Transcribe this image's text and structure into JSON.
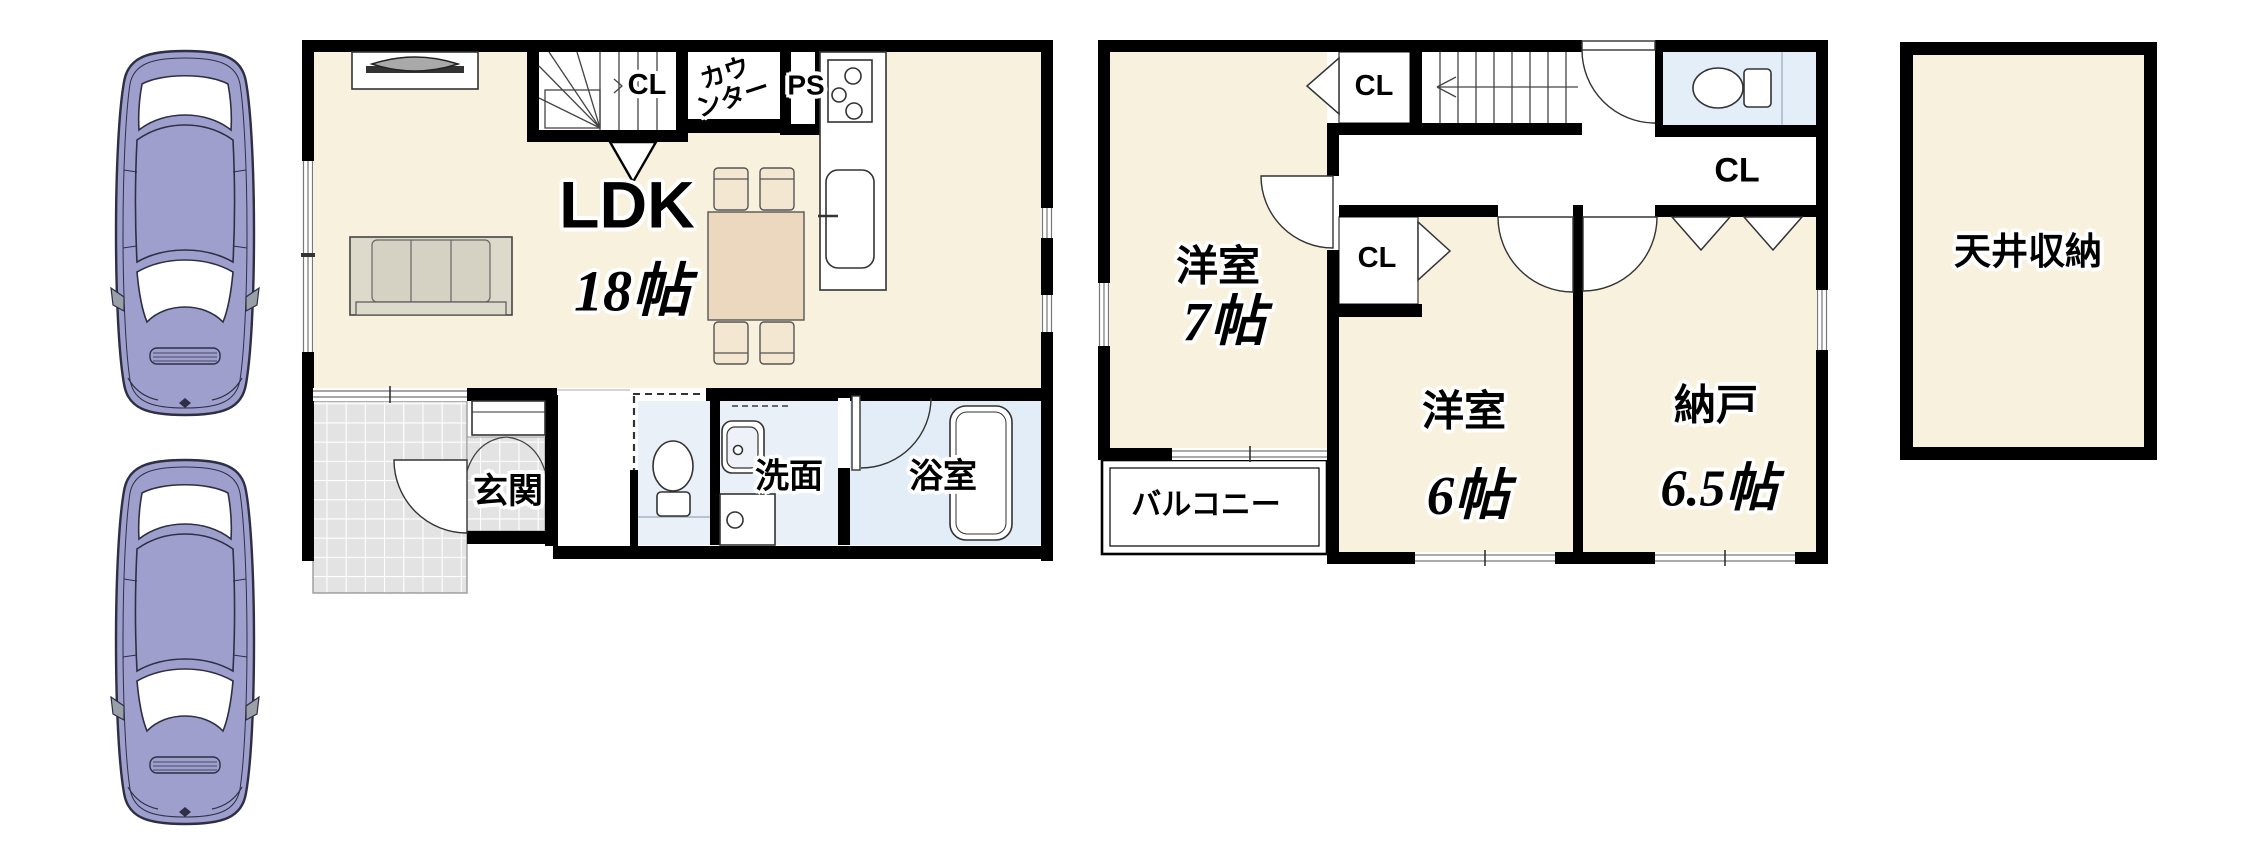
{
  "plan_title": "戸建て間取り図",
  "colors": {
    "room_beige": "#f8f1dd",
    "wall": "#000000",
    "wet_blue": "#e9f0f8",
    "bath_blue": "#e3edf8",
    "toilet_blue": "#e4eef9",
    "tile_gray": "#e3e3e3",
    "table_tan": "#ebd8bf",
    "chair_tan": "#f3e7d2",
    "sofa_cushion": "#d5d1c3",
    "sofa_frame": "#ddd9cb",
    "car_body": "#9f9fce",
    "car_line": "#2e2e44"
  },
  "floor1": {
    "ldk": {
      "label": "LDK",
      "size": "18帖"
    },
    "stair_closet": {
      "label": "CL"
    },
    "counter": {
      "line1": "カウ",
      "line2": "ンター"
    },
    "pipe_space": {
      "label": "PS"
    },
    "genkan": {
      "label": "玄関"
    },
    "senmen": {
      "label": "洗面"
    },
    "bathroom": {
      "label": "浴室"
    }
  },
  "floor2": {
    "closet_top": {
      "label": "CL"
    },
    "closet_mid": {
      "label": "CL"
    },
    "closet_right": {
      "label": "CL"
    },
    "room7": {
      "label": "洋室",
      "size": "7帖"
    },
    "room6": {
      "label": "洋室",
      "size": "6帖"
    },
    "nando": {
      "label": "納戸",
      "size": "6.5帖"
    },
    "balcony": {
      "label": "バルコニー"
    }
  },
  "attic": {
    "label": "天井収納"
  }
}
